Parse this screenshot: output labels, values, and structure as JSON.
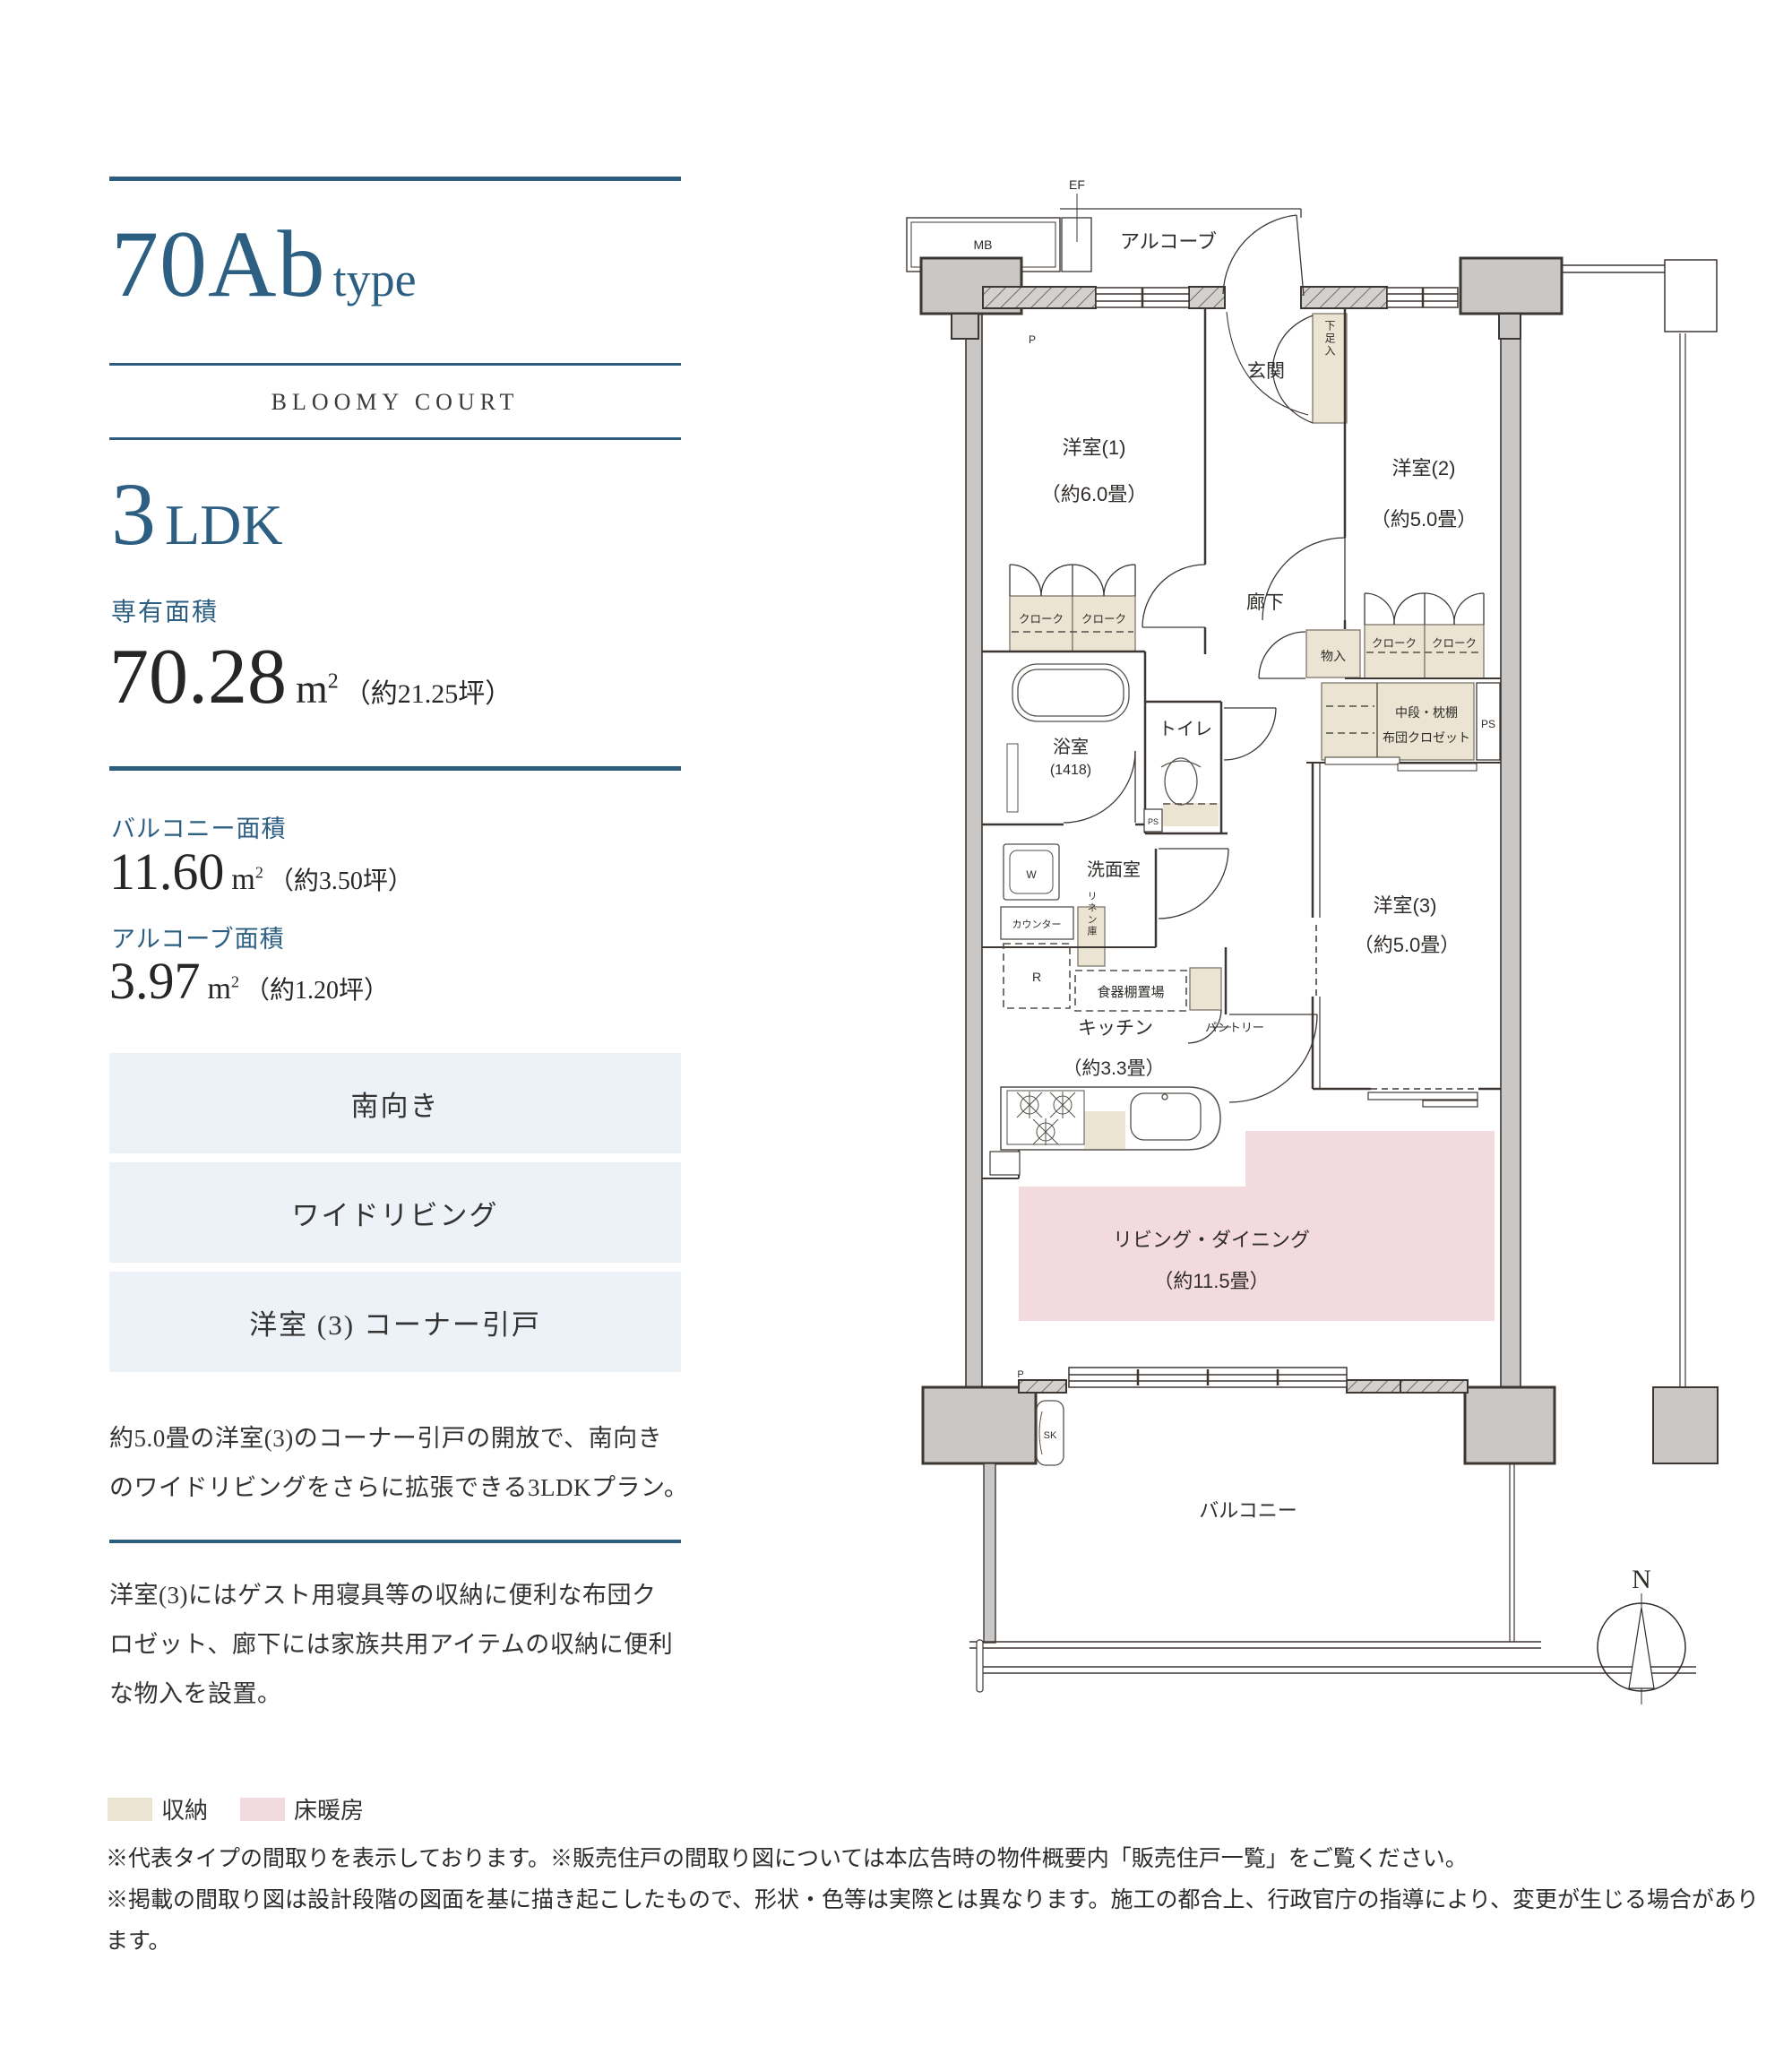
{
  "panel": {
    "type_name": "70Ab",
    "type_suffix": "type",
    "brand": "BLOOMY COURT",
    "layout_number": "3",
    "layout_letters": "LDK",
    "area_label": "専有面積",
    "area_value": "70.28",
    "area_unit": "m",
    "area_sup": "2",
    "area_tsubo": "（約21.25坪）",
    "balcony_label": "バルコニー面積",
    "balcony_value": "11.60",
    "balcony_tsubo": "（約3.50坪）",
    "alcove_label": "アルコーブ面積",
    "alcove_value": "3.97",
    "alcove_tsubo": "（約1.20坪）",
    "features": [
      "南向き",
      "ワイドリビング",
      "洋室 (3) コーナー引戸"
    ],
    "paragraph1": "約5.0畳の洋室(3)のコーナー引戸の開放で、南向き\nのワイドリビングをさらに拡張できる3LDKプラン。",
    "paragraph2": "洋室(3)にはゲスト用寝具等の収納に便利な布団ク\nロゼット、廊下には家族共用アイテムの収納に便利\nな物入を設置。"
  },
  "legend": {
    "storage_label": "収納",
    "heating_label": "床暖房",
    "storage_color": "#ebe4d2",
    "heating_color": "#f3dade"
  },
  "notes": [
    "※代表タイプの間取りを表示しております。※販売住戸の間取り図については本広告時の物件概要内「販売住戸一覧」をご覧ください。",
    "※掲載の間取り図は設計段階の図面を基に描き起こしたもので、形状・色等は実際とは異なります。施工の都合上、行政官庁の指導により、変更が生じる場合があります。"
  ],
  "fp": {
    "mb": "MB",
    "ef": "EF",
    "alcove": "アルコーブ",
    "entrance": "玄関",
    "shoe_box": "下足入",
    "bedroom1": "洋室(1)",
    "bedroom1_size": "（約6.0畳）",
    "bedroom2": "洋室(2)",
    "bedroom2_size": "（約5.0畳）",
    "bedroom3": "洋室(3)",
    "bedroom3_size": "（約5.0畳）",
    "hallway": "廊下",
    "closet": "クローク",
    "storage_small": "物入",
    "futon_line1": "中段・枕棚",
    "futon_line2": "布団クロゼット",
    "ps": "PS",
    "p": "P",
    "bath": "浴室",
    "bath_size": "(1418)",
    "toilet": "トイレ",
    "washroom": "洗面室",
    "washer": "W",
    "counter": "カウンター",
    "linen": "リネン庫",
    "fridge": "R",
    "dish_shelf": "食器棚置場",
    "pantry": "パントリー",
    "kitchen": "キッチン",
    "kitchen_size": "（約3.3畳）",
    "living": "リビング・ダイニング",
    "living_size": "（約11.5畳）",
    "balcony": "バルコニー",
    "sk": "SK",
    "north": "N"
  },
  "colors": {
    "accent_blue": "#2c5d7c",
    "heading_blue": "#2c5f82",
    "feature_box_bg": "#ecf2f7",
    "storage_beige": "#ebe4d2",
    "floor_heating_pink": "#f3dade",
    "column_gray": "#c9c8c6",
    "wall_dark": "#3d3733"
  }
}
